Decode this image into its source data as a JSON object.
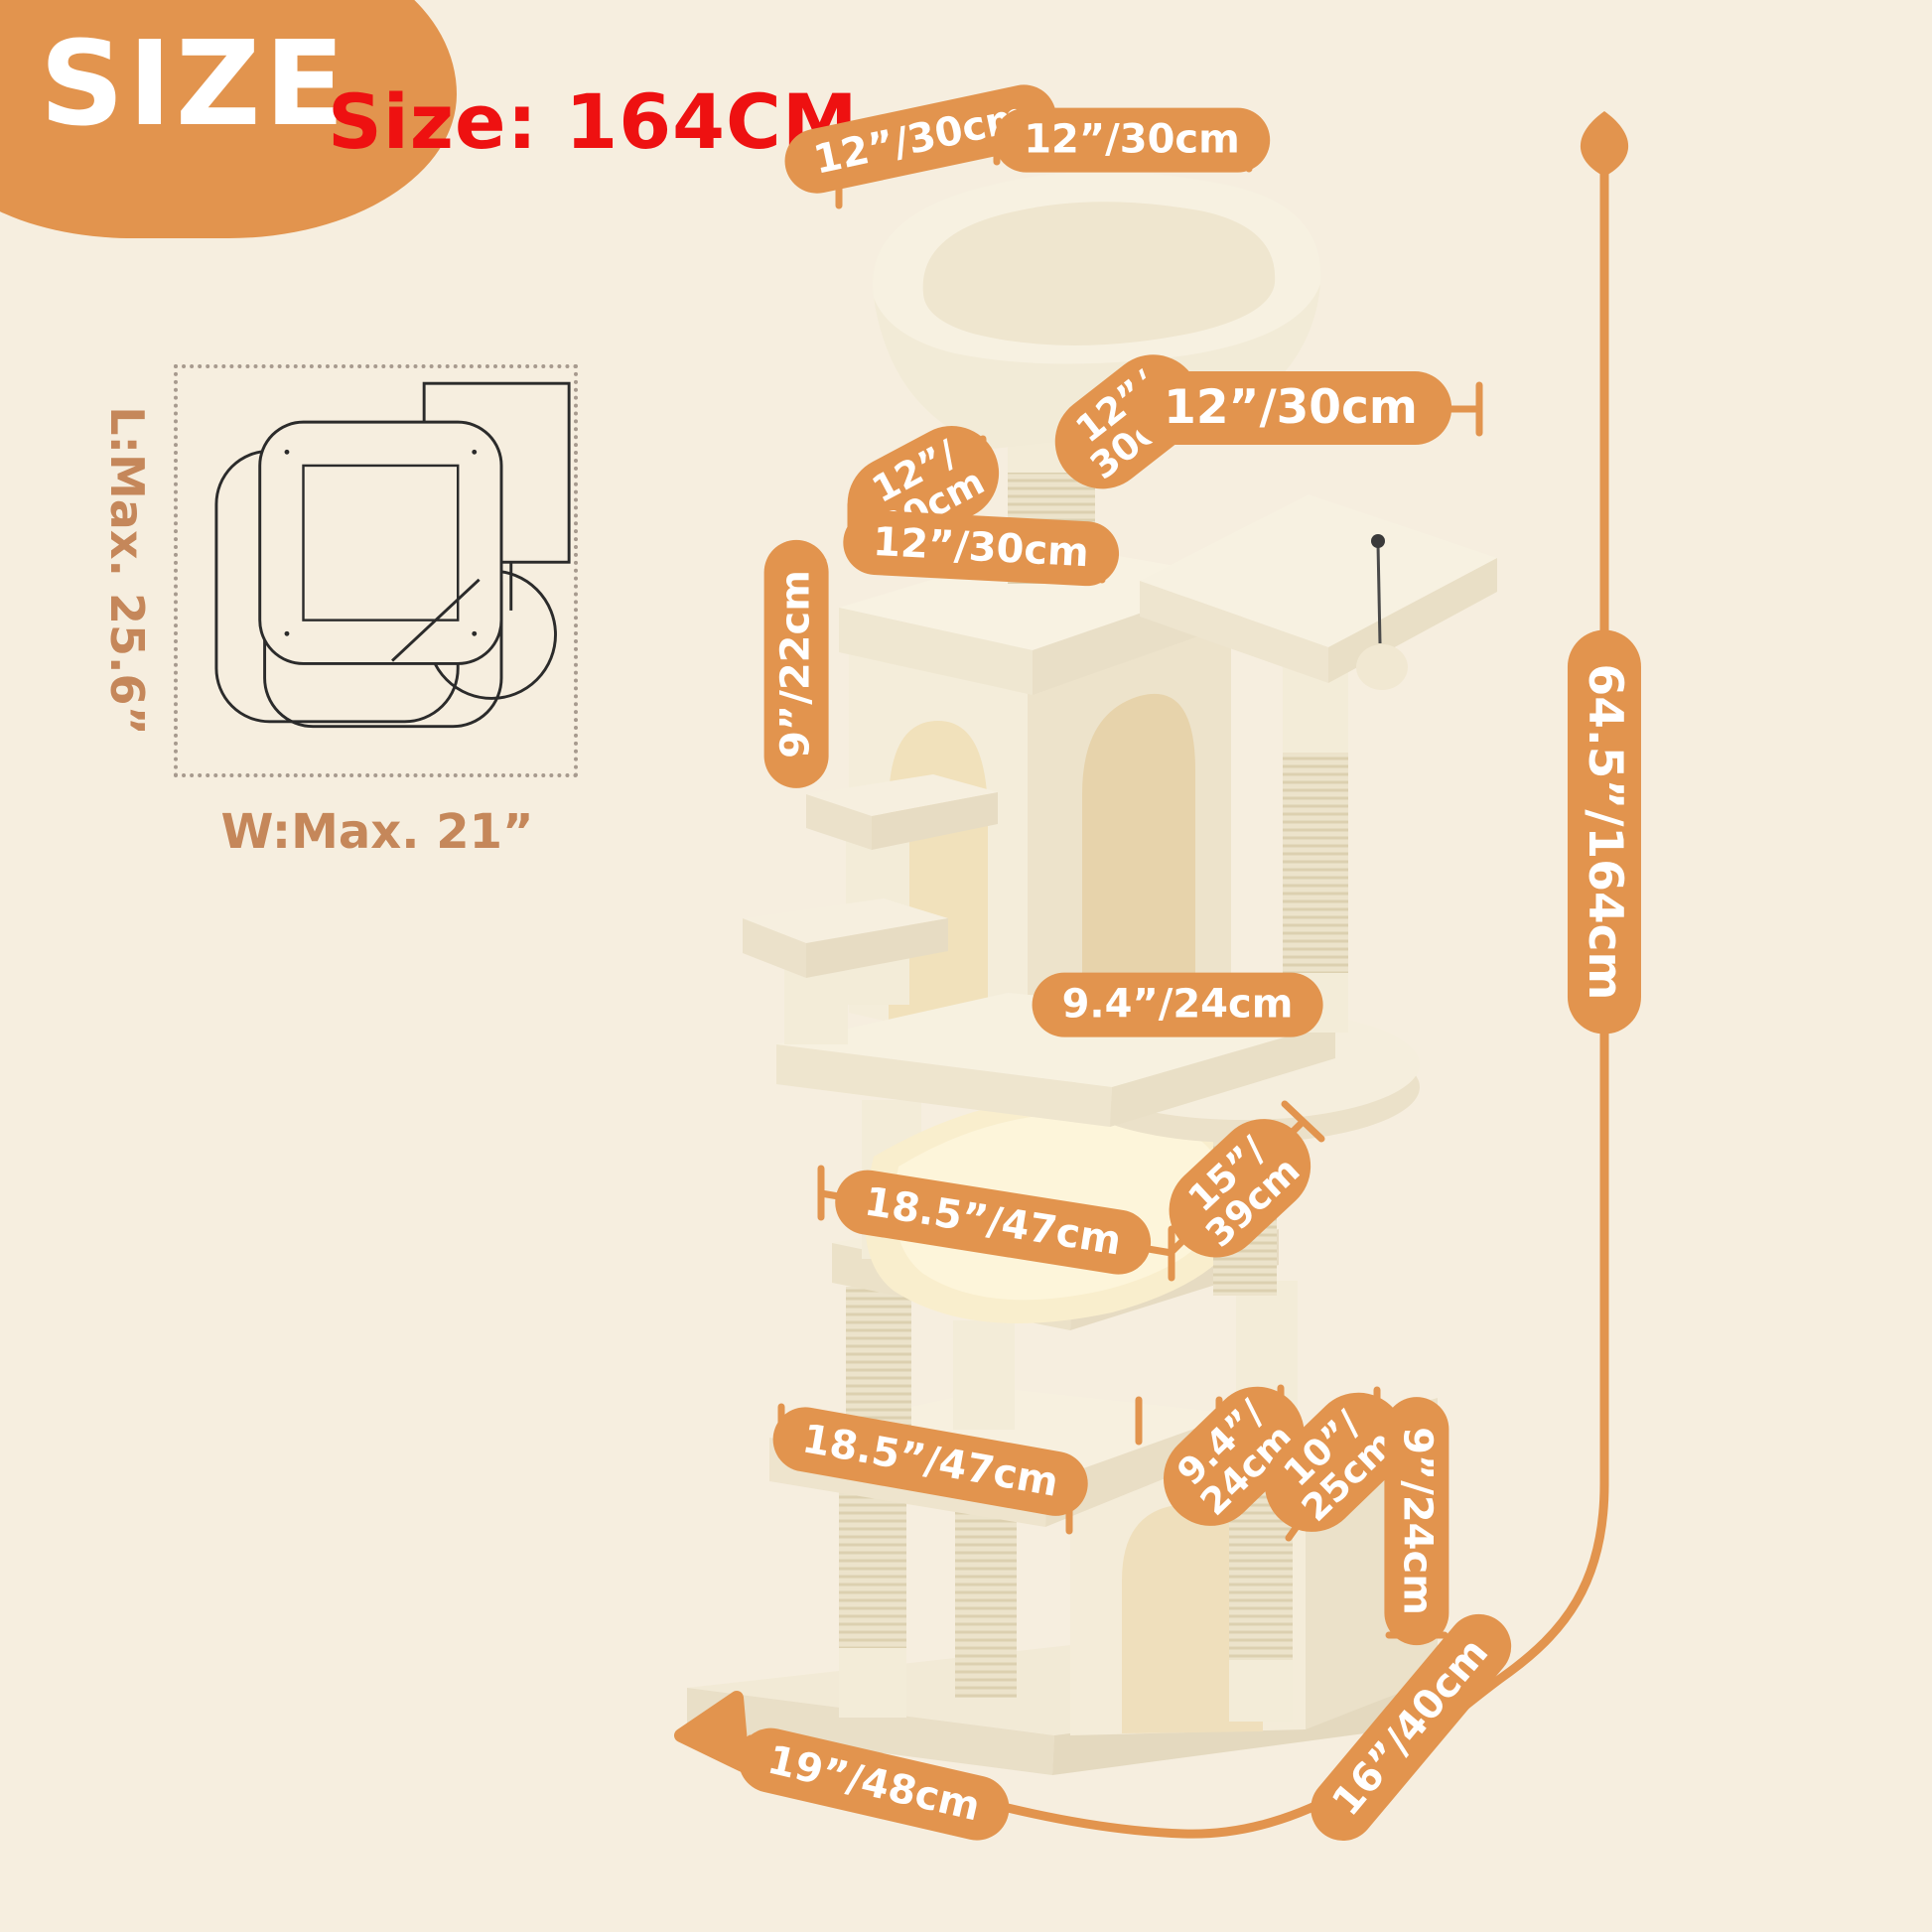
{
  "badge": {
    "label": "SIZE"
  },
  "heading": {
    "label": "Size: 164CM"
  },
  "footprint": {
    "length": "L:Max. 25.6”",
    "width": "W:Max. 21”"
  },
  "colors": {
    "background": "#f6eedf",
    "accent_orange": "#e2944e",
    "heading_red": "#ee1111",
    "footprint_text": "#c5875a",
    "pill_text": "#ffffff",
    "plush_cream": "#f7f1e1"
  },
  "labels": [
    {
      "text": "12”/30cm"
    },
    {
      "text": "12”/30cm"
    },
    {
      "text": "12”/\n30cm"
    },
    {
      "text": "12”/30cm"
    },
    {
      "text": "12”/\n30cm"
    },
    {
      "text": "12”/30cm"
    },
    {
      "text": "9”/22cm"
    },
    {
      "text": "64.5”/164cm"
    },
    {
      "text": "9.4”/24cm"
    },
    {
      "text": "18.5”/47cm"
    },
    {
      "text": "15”/\n39cm"
    },
    {
      "text": "18.5”/47cm"
    },
    {
      "text": "9.4”/\n24cm"
    },
    {
      "text": "10”/\n25cm"
    },
    {
      "text": "9”/24cm"
    },
    {
      "text": "16”/40cm"
    },
    {
      "text": "19”/48cm"
    }
  ]
}
